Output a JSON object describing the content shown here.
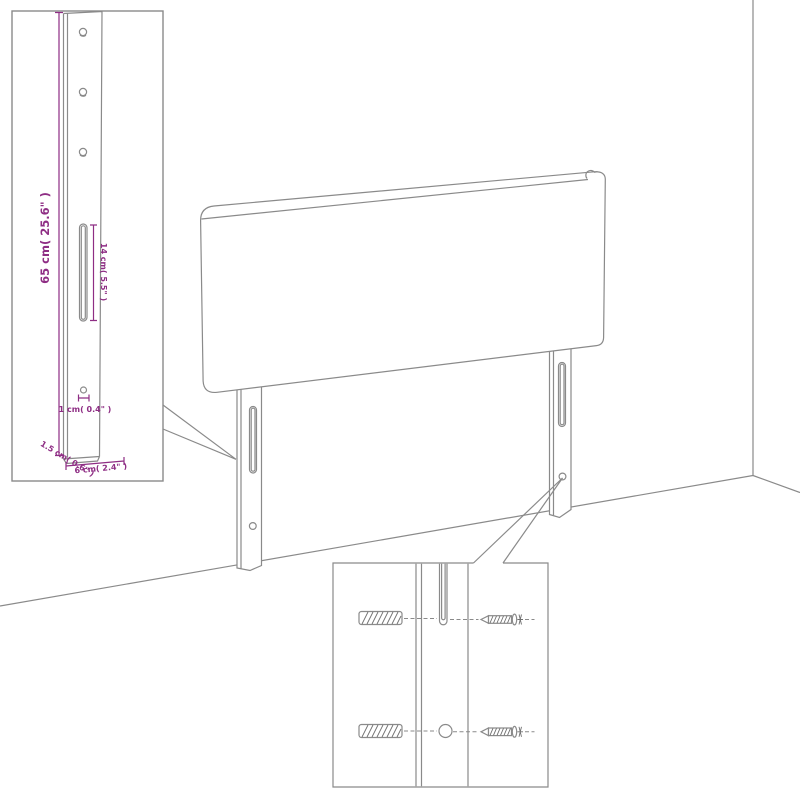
{
  "diagram": {
    "kind": "headboard-assembly-diagram",
    "colors": {
      "line_gray": "#8a8a8a",
      "dimension_purple": "#8e2d84",
      "background": "#ffffff"
    },
    "labels": {
      "bracket_height": "65 cm( 25.6\" )",
      "slot_length": "14 cm( 5.5\" )",
      "hole_diameter": "1 cm( 0.4\" )",
      "bracket_thickness": "1.5 cm( 0.6\" )",
      "bracket_width": "6 cm( 2.4\" )"
    }
  }
}
